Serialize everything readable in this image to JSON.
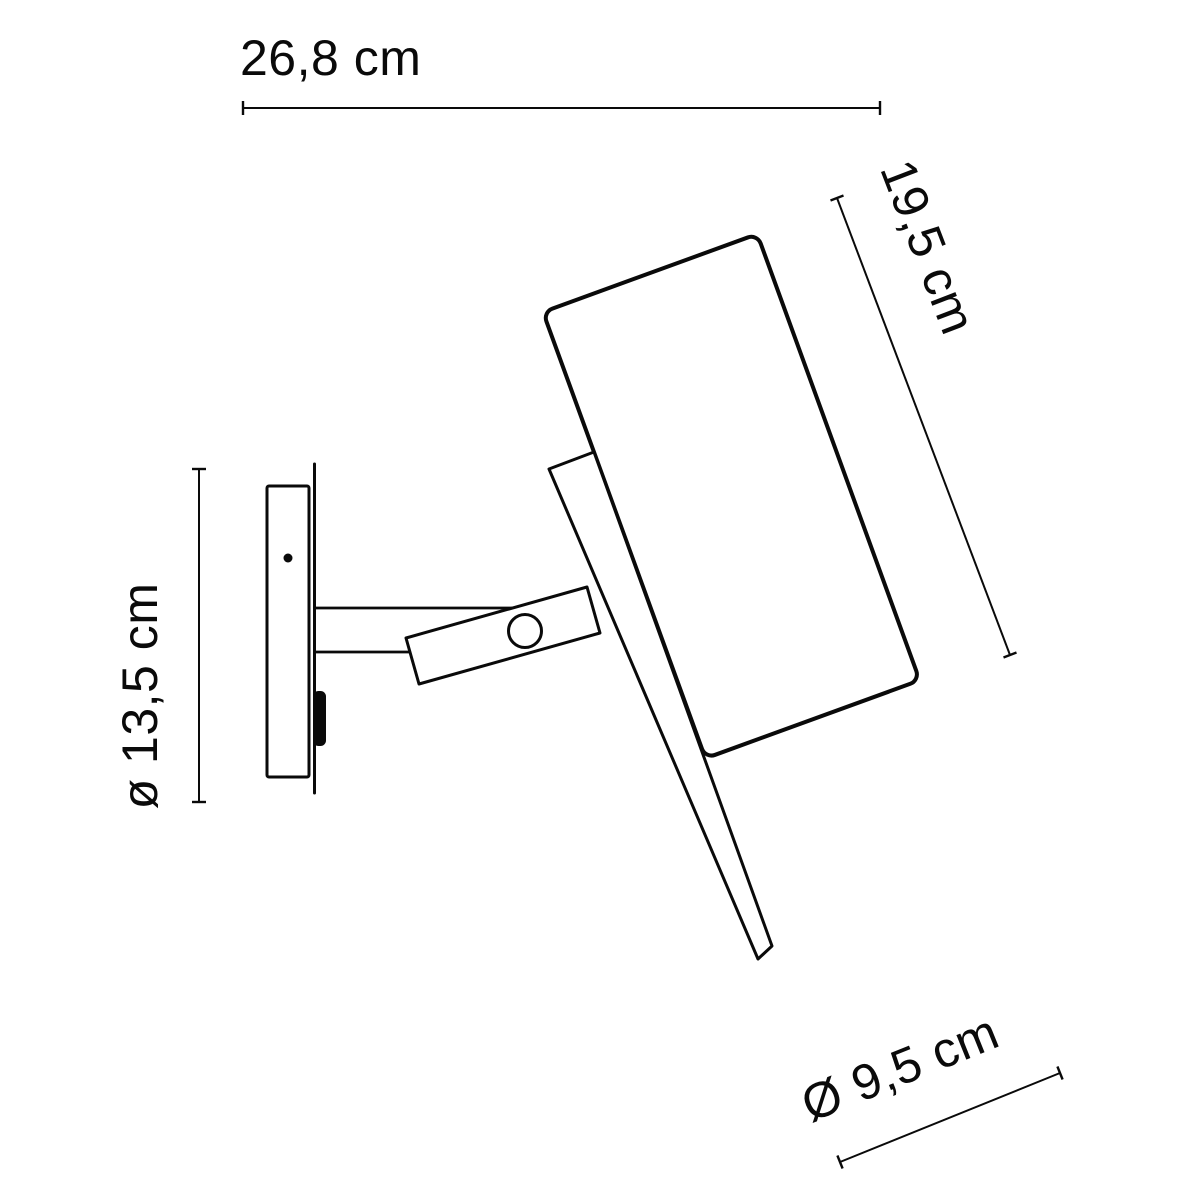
{
  "theme": {
    "background": "#ffffff",
    "line_color": "#0a0a0a"
  },
  "dimensions": {
    "width": {
      "label": "26,8 cm",
      "value_cm": 26.8
    },
    "height": {
      "label": "19,5 cm",
      "value_cm": 19.5
    },
    "backplate_diameter": {
      "label": "ø 13,5 cm",
      "value_cm": 13.5
    },
    "shade_diameter": {
      "label": "Ø 9,5 cm",
      "value_cm": 9.5
    }
  }
}
